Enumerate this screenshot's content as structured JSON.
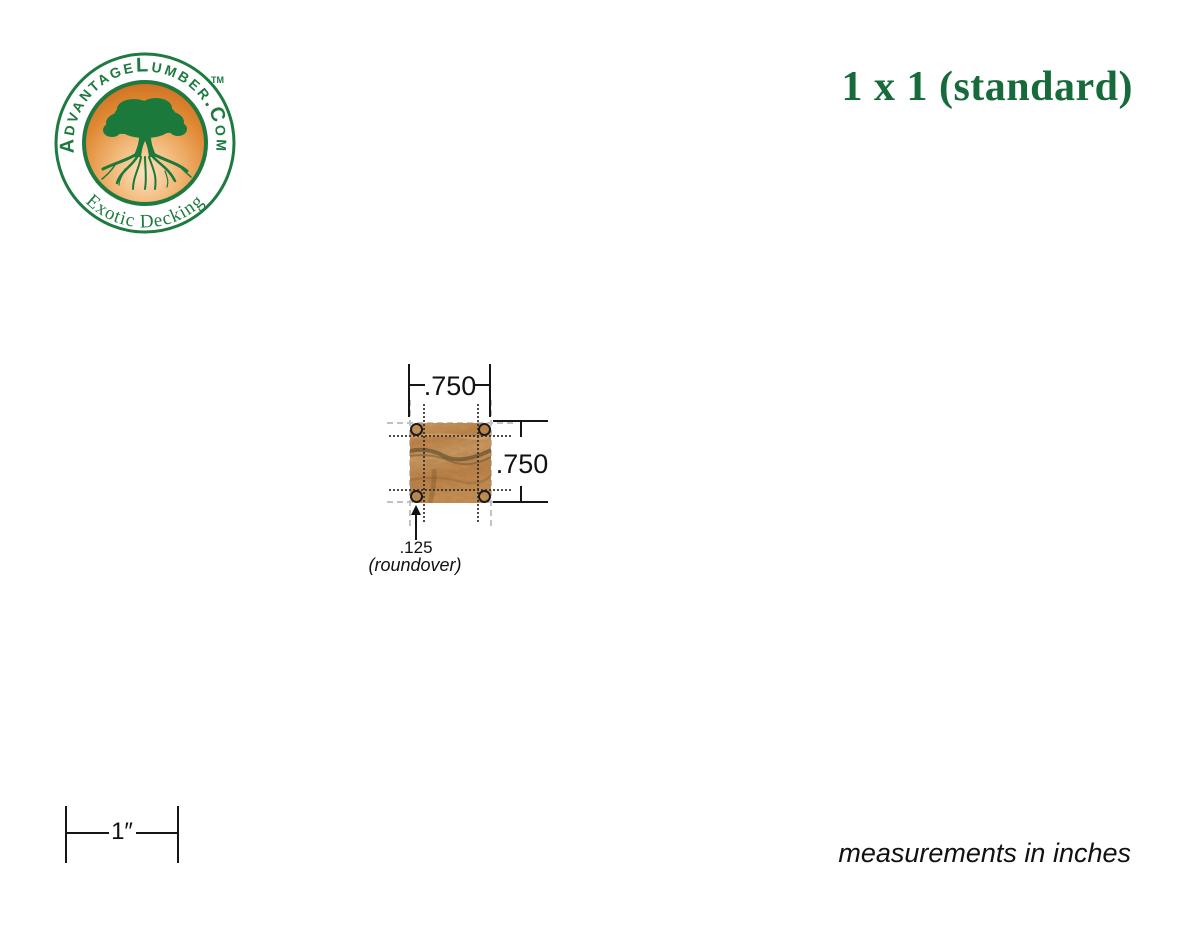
{
  "canvas": {
    "background": "#ffffff",
    "width": 1200,
    "height": 927
  },
  "logo": {
    "brand": "AdvantageLumber.Com",
    "tagline": "Exotic Decking",
    "trademark": "TM",
    "colors": {
      "green": "#1e7a40",
      "orange_dark": "#cc6c1d",
      "orange_mid": "#e9a055",
      "orange_light": "#fce3bf"
    }
  },
  "title": {
    "text": "1 x 1 (standard)",
    "color": "#176b3a"
  },
  "diagram": {
    "width_label": ".750",
    "height_label": ".750",
    "roundover_value": ".125",
    "roundover_caption": "(roundover)",
    "wood_colors": {
      "base": "#c98f54",
      "mid": "#bd8148",
      "dark_streak": "#4e4227",
      "light": "#d9b184"
    }
  },
  "scale_bar": {
    "label": "1″"
  },
  "footer": {
    "note": "measurements in inches"
  }
}
